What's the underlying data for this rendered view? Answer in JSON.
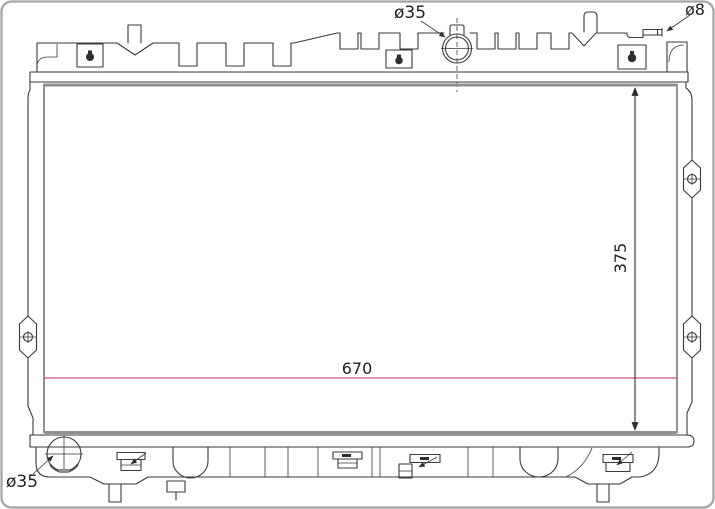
{
  "meta": {
    "title": "Radiator technical line drawing",
    "view": "front elevation with dimensions"
  },
  "colors": {
    "background": "#ffffff",
    "frame": "#a3a3a3",
    "line": "#3a3a3a",
    "core_shade": "#8f8f8f",
    "dimension_accent": "#bf2a52",
    "text": "#1f1f1f"
  },
  "annotations": {
    "filler_neck_diameter": {
      "label": "ø35"
    },
    "overflow_pipe_diameter": {
      "label": "ø8"
    },
    "core_height": {
      "label": "375"
    },
    "core_width": {
      "label": "670"
    },
    "outlet_diameter": {
      "label": "ø35"
    }
  }
}
